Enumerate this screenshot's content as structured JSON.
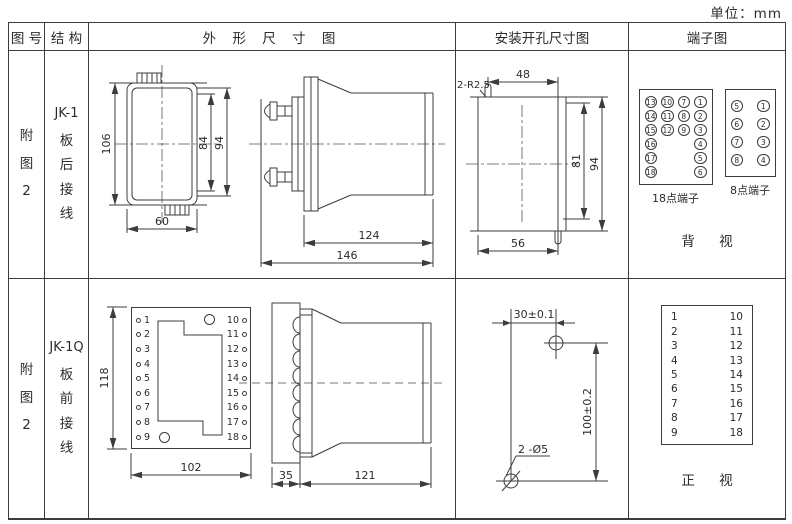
{
  "unit_label": "单位：mm",
  "header": {
    "fig_no": "图 号",
    "structure": "结 构",
    "outline": "外 形 尺 寸 图",
    "install": "安装开孔尺寸图",
    "terminal": "端子图"
  },
  "row1": {
    "fig_no": [
      "附",
      "图",
      "2"
    ],
    "structure": [
      "JK-1",
      "板",
      "后",
      "接",
      "线"
    ],
    "outline_dims": {
      "h106": "106",
      "h84": "84",
      "h94": "94",
      "w60": "60",
      "l124": "124",
      "l146": "146"
    },
    "install_dims": {
      "slots": "2-R2.5",
      "w48": "48",
      "h81": "81",
      "h94": "94",
      "w56": "56"
    },
    "terminal18": {
      "rows": [
        [
          "13",
          "10",
          "7",
          "1"
        ],
        [
          "14",
          "11",
          "8",
          "2"
        ],
        [
          "15",
          "12",
          "9",
          "3"
        ],
        [
          "16",
          "",
          "",
          "4"
        ],
        [
          "17",
          "",
          "",
          "5"
        ],
        [
          "18",
          "",
          "",
          "6"
        ]
      ],
      "label": "18点端子"
    },
    "terminal8": {
      "rows": [
        [
          "5",
          "1"
        ],
        [
          "6",
          "2"
        ],
        [
          "7",
          "3"
        ],
        [
          "8",
          "4"
        ]
      ],
      "label": "8点端子"
    },
    "view_label": "背 视"
  },
  "row2": {
    "fig_no": [
      "附",
      "图",
      "2"
    ],
    "structure": [
      "JK-1Q",
      "板",
      "前",
      "接",
      "线"
    ],
    "outline_dims": {
      "h118": "118",
      "w102": "102",
      "w35": "35",
      "l121": "121"
    },
    "panel_terminals_left": [
      "1",
      "2",
      "3",
      "4",
      "5",
      "6",
      "7",
      "8",
      "9"
    ],
    "panel_terminals_right": [
      "10",
      "11",
      "12",
      "13",
      "14",
      "15",
      "16",
      "17",
      "18"
    ],
    "install_dims": {
      "w30": "30±0.1",
      "h100": "100±0.2",
      "holes": "2 -Ø5"
    },
    "terminal_block": {
      "left": [
        "1",
        "2",
        "3",
        "4",
        "5",
        "6",
        "7",
        "8",
        "9"
      ],
      "right": [
        "10",
        "11",
        "12",
        "13",
        "14",
        "15",
        "16",
        "17",
        "18"
      ]
    },
    "view_label": "正 视"
  },
  "colors": {
    "line": "#3c3c3c",
    "background": "#ffffff"
  }
}
